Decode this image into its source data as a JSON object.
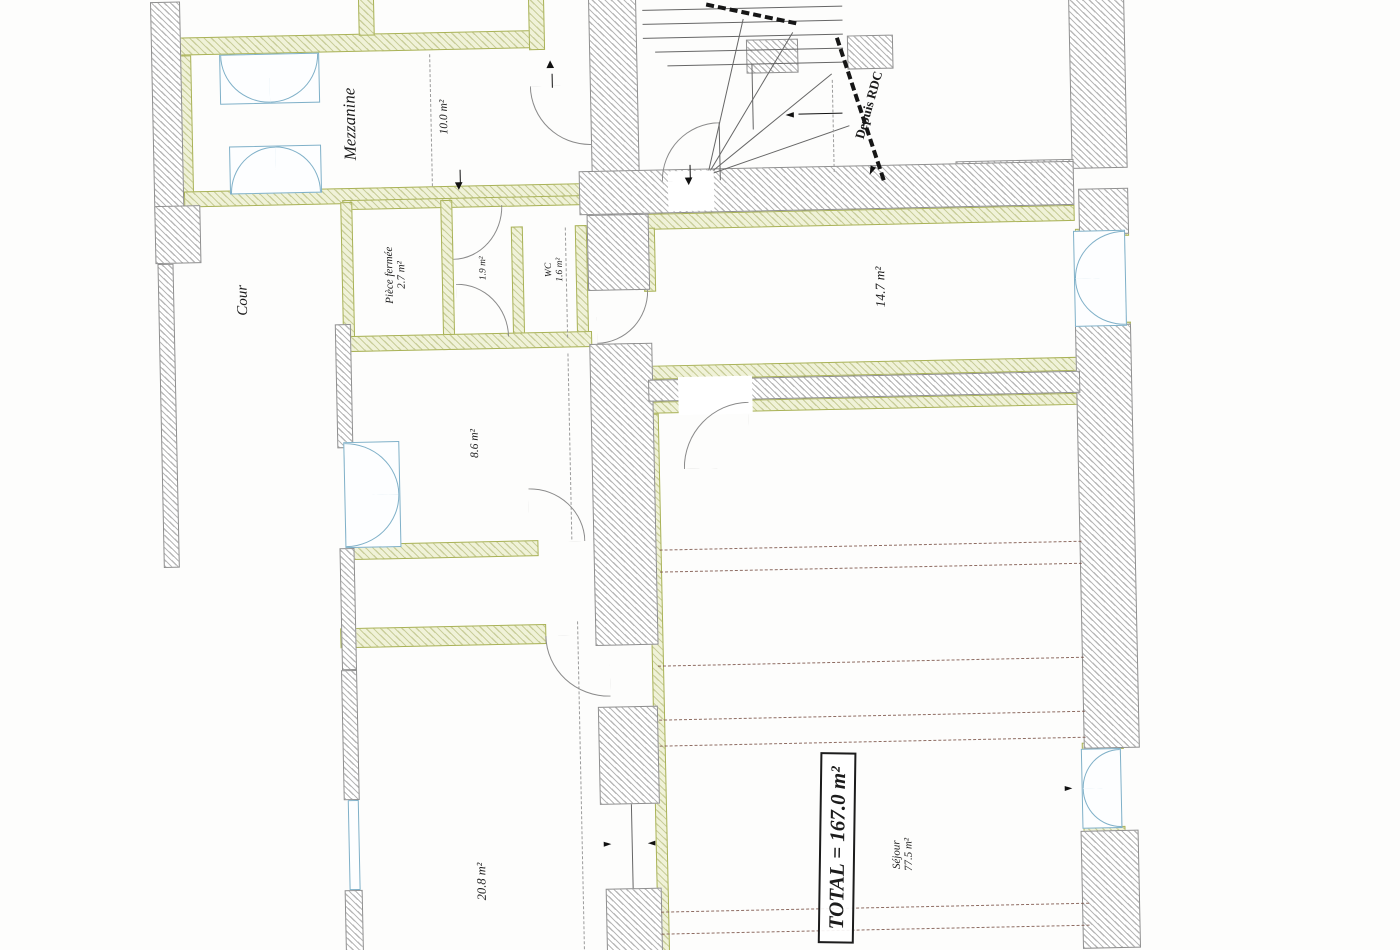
{
  "plan": {
    "rooms": {
      "mezzanine": {
        "name": "Mezzanine"
      },
      "open_area": {
        "area": "10.0 m²"
      },
      "cour": {
        "name": "Cour"
      },
      "piece_fermee": {
        "name": "Pièce fermée",
        "area": "2.7 m²"
      },
      "vestibule": {
        "area": "1.9 m²"
      },
      "wc": {
        "name": "WC",
        "area": "1.6 m²"
      },
      "room_14_7": {
        "area": "14.7 m²"
      },
      "room_8_6": {
        "area": "8.6 m²"
      },
      "room_20_8": {
        "area": "20.8 m²"
      },
      "sejour": {
        "name": "Séjour",
        "area": "77.5 m²"
      }
    },
    "annotations": {
      "total": "TOTAL = 167.0 m²",
      "stairs_origin": "Depuis RDC"
    },
    "colors": {
      "partition": "#a9b257",
      "partition_fill": "#f0f2d8",
      "window": "#7fb0c8",
      "wall_outline": "#8f8f8f",
      "ceiling_dash": "#7b5348",
      "ink": "#1c1c1c"
    }
  }
}
